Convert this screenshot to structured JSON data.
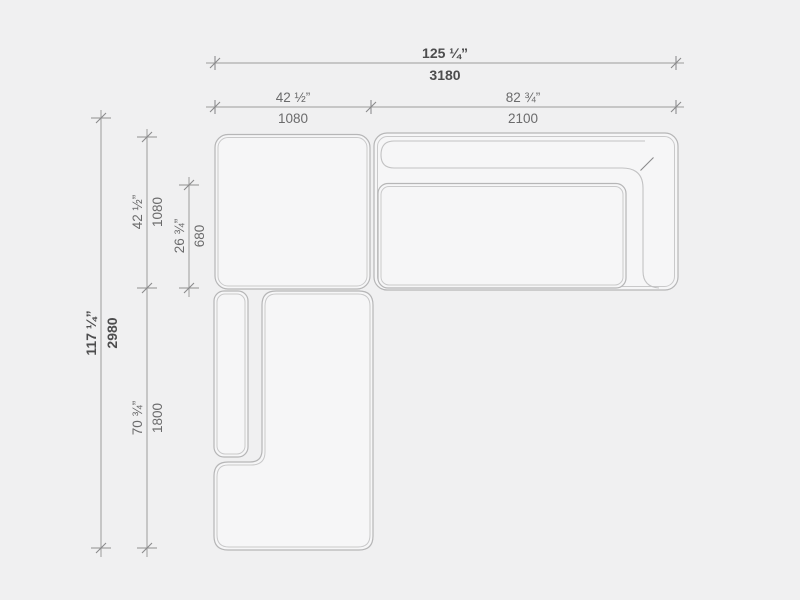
{
  "diagram": {
    "type": "sofa-plan-dimension-drawing",
    "dims": {
      "overall_width": {
        "imperial": "125 ¼”",
        "metric": "3180"
      },
      "left_section_width": {
        "imperial": "42 ½”",
        "metric": "1080"
      },
      "right_section_width": {
        "imperial": "82 ¾”",
        "metric": "2100"
      },
      "overall_depth": {
        "imperial": "117 ¼”",
        "metric": "2980"
      },
      "corner_module_depth": {
        "imperial": "42 ½”",
        "metric": "1080"
      },
      "seat_depth": {
        "imperial": "26 ¾”",
        "metric": "680"
      },
      "chaise_length": {
        "imperial": "70 ¾”",
        "metric": "1800"
      }
    },
    "colors": {
      "background": "#f0f0f1",
      "module_fill": "#f6f6f7",
      "outline": "#b6b6b7",
      "inner_line": "#c9c9ca",
      "dimension_line": "#9b9b9c",
      "text_primary": "#4d4d4e",
      "text_secondary": "#6b6b6c"
    }
  }
}
